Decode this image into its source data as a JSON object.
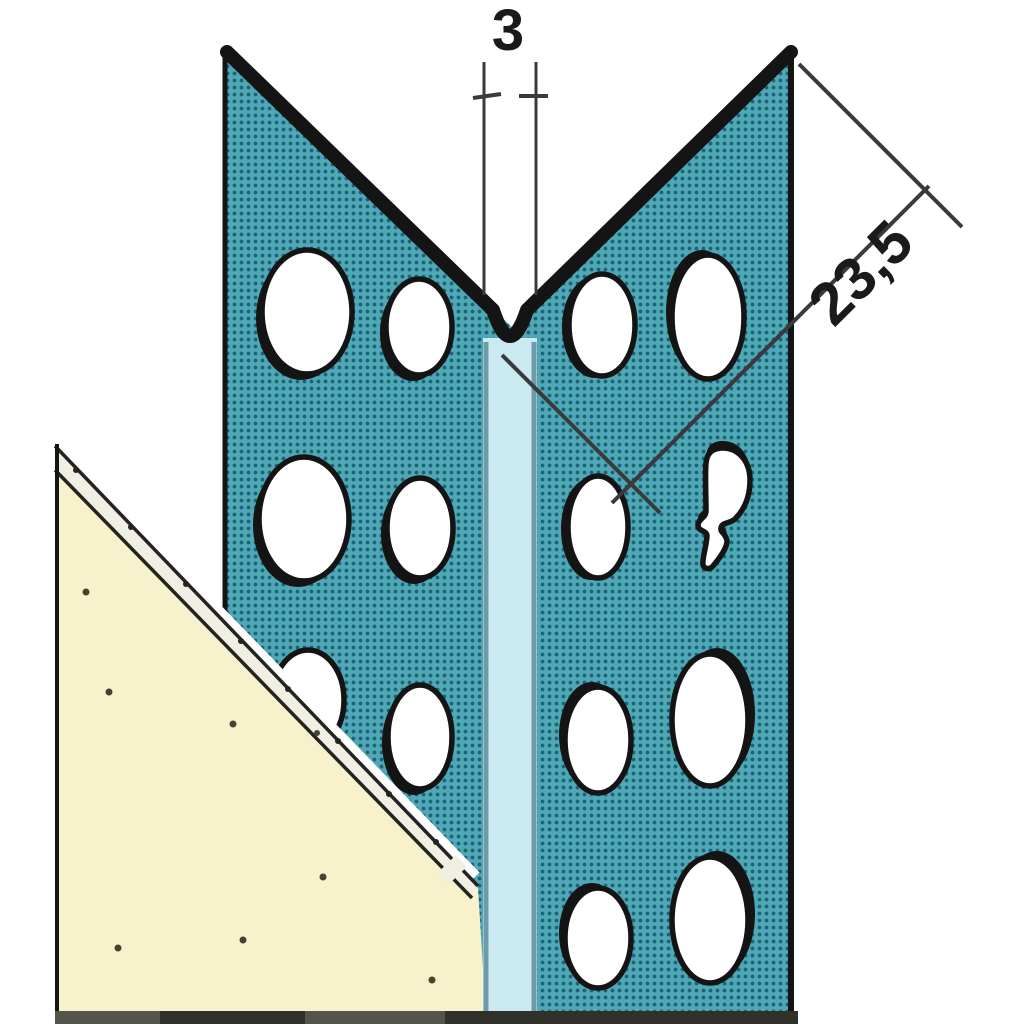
{
  "diagram": {
    "dimension_labels": {
      "bead_width": "3",
      "flange_width": "23,5"
    }
  },
  "colors": {
    "background": "#ffffff",
    "flange_base": "#4fa8b6",
    "flange_dot": "#1e6375",
    "outline": "#141414",
    "hole_fill": "#ffffff",
    "bead_fill": "#cbe9f1",
    "bead_edge": "#6f9aa8",
    "board_fill": "#f7f2cb",
    "band_fill": "#f1efe4",
    "band_line": "#23231f",
    "speck": "#44442e",
    "line_color": "#3a3a3a",
    "text_color": "#1a1a1a",
    "base_bar": "#55544c",
    "base_bar_dark": "#31312c"
  }
}
